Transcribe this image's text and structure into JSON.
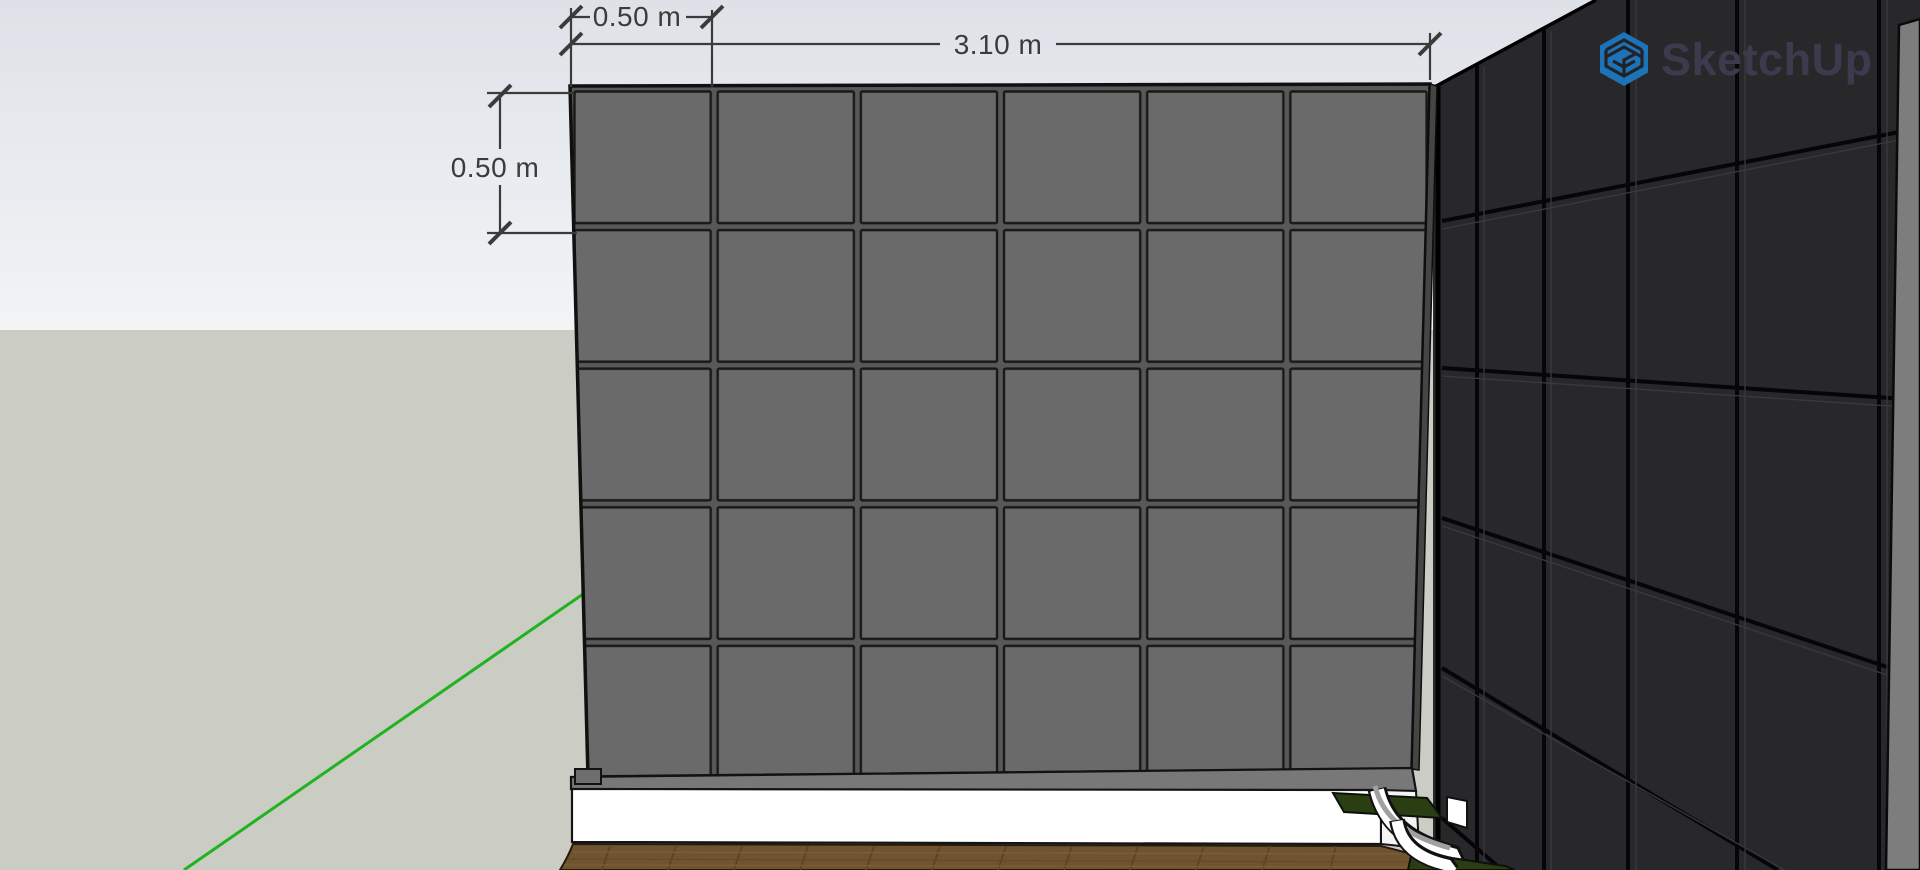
{
  "watermark": {
    "brand": "SketchUp",
    "icon": "sketchup-cube-icon",
    "icon_color": "#1d73b7",
    "text_color": "#3b3b4d"
  },
  "annotations": {
    "dim_tile_width": {
      "label": "0.50 m"
    },
    "dim_wall_width": {
      "label": "3.10 m"
    },
    "dim_tile_height": {
      "label": "0.50 m"
    }
  },
  "colors": {
    "sky-top": "#dee2e8",
    "sky-horizon": "#f2f4f6",
    "ground": "#cbccc4",
    "front-tile": "#6a6a6a",
    "front-grout": "#585858",
    "side-tile": "#28282b",
    "side-end": "#7d7d7d",
    "dim-color": "#3b3b3b",
    "axis-green": "#1fb41f",
    "wood": "#6f5430",
    "plinth": "#ffffff",
    "planter": "#2b3e13",
    "logo-blue": "#1d73b7",
    "logo-text": "#3b3b4d"
  }
}
